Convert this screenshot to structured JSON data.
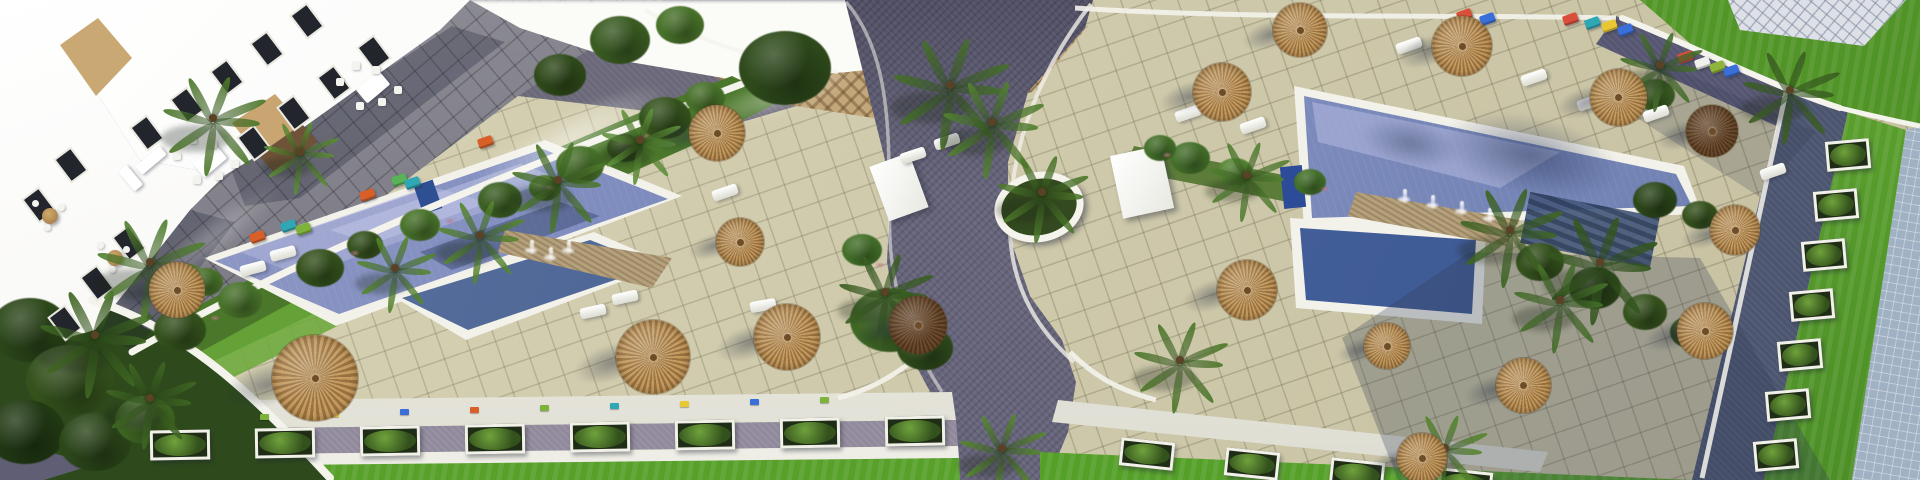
{
  "scene": {
    "kind": "aerial-architectural-render",
    "subject": "resort apartment complex with two swimming pools, tiled sun decks, straw parasols, palm gardens, paths and lawns",
    "view": "top-down oblique"
  },
  "palette": {
    "deck": "#d0caa8",
    "deck_line": "#5e563a",
    "terrace_tile": "#7d7c87",
    "road": "#615f76",
    "gravel": "#918a9c",
    "lawn": "#5aa12d",
    "garden": "#4b772b",
    "pool_rim": "#f2f1ea",
    "water_light": "#9aa0cc",
    "water_dark": "#49679f",
    "umbrella_tan": "#c49a5f",
    "umbrella_tan_dark": "#97713e",
    "umbrella_brown": "#6e4c2c",
    "rooftop": "#a0b1c4",
    "rock": "#b5a07a",
    "building_white": "#fbfbf7",
    "building_tan": "#c9a571"
  },
  "umbrellas": [
    [
      177,
      290,
      56,
      "t"
    ],
    [
      315,
      378,
      86,
      "t"
    ],
    [
      653,
      357,
      74,
      "t"
    ],
    [
      787,
      337,
      66,
      "t"
    ],
    [
      717,
      133,
      56,
      "t"
    ],
    [
      740,
      242,
      48,
      "t"
    ],
    [
      918,
      325,
      58,
      "d"
    ],
    [
      1222,
      92,
      58,
      "t"
    ],
    [
      1300,
      30,
      54,
      "t"
    ],
    [
      1462,
      46,
      60,
      "t"
    ],
    [
      1618,
      97,
      57,
      "t"
    ],
    [
      1712,
      131,
      52,
      "d"
    ],
    [
      1247,
      290,
      60,
      "t"
    ],
    [
      1735,
      230,
      50,
      "t"
    ],
    [
      1705,
      331,
      56,
      "t"
    ],
    [
      1523,
      385,
      55,
      "t"
    ],
    [
      1387,
      346,
      46,
      "t"
    ],
    [
      1422,
      458,
      50,
      "t"
    ]
  ],
  "palms": [
    [
      213,
      118,
      55,
      "#4e7a2b"
    ],
    [
      300,
      152,
      40,
      "#5d8f33"
    ],
    [
      395,
      268,
      42,
      "#57892e"
    ],
    [
      480,
      235,
      46,
      "#57892e"
    ],
    [
      558,
      180,
      50,
      "#4e7a2b"
    ],
    [
      640,
      140,
      42,
      "#61943a"
    ],
    [
      95,
      335,
      60,
      "#3f6623"
    ],
    [
      150,
      398,
      48,
      "#3f6623"
    ],
    [
      150,
      262,
      58,
      "#538231"
    ],
    [
      950,
      85,
      62,
      "#46702a"
    ],
    [
      992,
      122,
      54,
      "#538231"
    ],
    [
      1042,
      192,
      48,
      "#4e7a2b"
    ],
    [
      885,
      292,
      50,
      "#3c6023"
    ],
    [
      1002,
      448,
      46,
      "#57892e"
    ],
    [
      1247,
      175,
      44,
      "#538231"
    ],
    [
      1510,
      230,
      55,
      "#3f6623"
    ],
    [
      1600,
      262,
      60,
      "#35581e"
    ],
    [
      1560,
      300,
      50,
      "#46702a"
    ],
    [
      1660,
      65,
      44,
      "#46702a"
    ],
    [
      1790,
      90,
      52,
      "#3c6023"
    ],
    [
      1445,
      448,
      44,
      "#57892e"
    ],
    [
      1180,
      360,
      50,
      "#4e7a2b"
    ]
  ],
  "bushes": [
    [
      180,
      330,
      26,
      "#35521d"
    ],
    [
      240,
      300,
      22,
      "#48722a"
    ],
    [
      320,
      268,
      24,
      "#35521d"
    ],
    [
      420,
      225,
      20,
      "#48722a"
    ],
    [
      500,
      200,
      22,
      "#3c6023"
    ],
    [
      580,
      165,
      24,
      "#48722a"
    ],
    [
      665,
      118,
      26,
      "#35521d"
    ],
    [
      705,
      98,
      20,
      "#48722a"
    ],
    [
      620,
      40,
      30,
      "#3a5c22"
    ],
    [
      680,
      25,
      24,
      "#48722a"
    ],
    [
      560,
      75,
      26,
      "#2f4a1a"
    ],
    [
      785,
      68,
      46,
      "#2e4a1b"
    ],
    [
      890,
      320,
      40,
      "#3f6824"
    ],
    [
      925,
      348,
      28,
      "#2e4a1b"
    ],
    [
      862,
      250,
      20,
      "#44702a"
    ],
    [
      1190,
      158,
      20,
      "#44702a"
    ],
    [
      1235,
      172,
      18,
      "#538231"
    ],
    [
      1310,
      182,
      16,
      "#44702a"
    ],
    [
      1540,
      262,
      24,
      "#35521d"
    ],
    [
      1595,
      288,
      26,
      "#2c471a"
    ],
    [
      1645,
      312,
      22,
      "#35521d"
    ],
    [
      1690,
      332,
      20,
      "#2c471a"
    ],
    [
      30,
      330,
      40,
      "#2c471a"
    ],
    [
      70,
      380,
      44,
      "#35521d"
    ],
    [
      25,
      432,
      40,
      "#223a14"
    ],
    [
      95,
      442,
      36,
      "#2c471a"
    ],
    [
      145,
      420,
      30,
      "#3f6623"
    ],
    [
      1655,
      95,
      20,
      "#3c6023"
    ],
    [
      205,
      282,
      18,
      "#48722a"
    ],
    [
      365,
      245,
      18,
      "#35521d"
    ],
    [
      545,
      188,
      16,
      "#48722a"
    ],
    [
      625,
      148,
      18,
      "#35521d"
    ],
    [
      1160,
      148,
      16,
      "#44702a"
    ],
    [
      1655,
      200,
      22,
      "#2c471a"
    ],
    [
      1700,
      215,
      18,
      "#35521d"
    ]
  ],
  "flower_tufts": [
    [
      210,
      315
    ],
    [
      350,
      250
    ],
    [
      545,
      185
    ],
    [
      640,
      133
    ],
    [
      875,
      262
    ],
    [
      1162,
      152
    ],
    [
      1320,
      186
    ],
    [
      445,
      218
    ],
    [
      700,
      112
    ]
  ],
  "windows": [
    [
      365,
      40
    ],
    [
      325,
      70
    ],
    [
      285,
      100
    ],
    [
      245,
      130
    ],
    [
      298,
      8
    ],
    [
      258,
      36
    ],
    [
      218,
      64
    ],
    [
      178,
      92
    ],
    [
      138,
      120
    ],
    [
      120,
      230
    ],
    [
      88,
      270
    ],
    [
      56,
      310
    ],
    [
      62,
      152
    ],
    [
      30,
      192
    ]
  ],
  "white_loungers": [
    [
      240,
      263,
      -15
    ],
    [
      270,
      248,
      -15
    ],
    [
      580,
      306,
      -12
    ],
    [
      612,
      292,
      -12
    ],
    [
      750,
      300,
      -10
    ],
    [
      712,
      187,
      -19
    ],
    [
      900,
      150,
      -18
    ],
    [
      934,
      136,
      -18
    ],
    [
      1396,
      40,
      -19
    ],
    [
      1445,
      48,
      -19
    ],
    [
      1521,
      72,
      -19
    ],
    [
      1577,
      97,
      -19
    ],
    [
      1643,
      108,
      -19
    ],
    [
      1760,
      166,
      -19
    ],
    [
      1240,
      120,
      -19
    ],
    [
      1175,
      108,
      -19
    ]
  ],
  "color_loungers": [
    [
      250,
      232,
      "#d95f28"
    ],
    [
      281,
      221,
      "#2fa7b5"
    ],
    [
      296,
      224,
      "#7fb23a"
    ],
    [
      360,
      190,
      "#d95f28"
    ],
    [
      392,
      175,
      "#59b357"
    ],
    [
      405,
      178,
      "#2fa7b5"
    ],
    [
      478,
      137,
      "#d95f28"
    ],
    [
      1457,
      10,
      "#d94f3a"
    ],
    [
      1480,
      14,
      "#3a6fd9"
    ],
    [
      1563,
      14,
      "#d94f3a"
    ],
    [
      1585,
      18,
      "#2fa7b5"
    ],
    [
      1602,
      21,
      "#e8c832"
    ],
    [
      1618,
      25,
      "#3a6fd9"
    ],
    [
      1678,
      52,
      "#d94f3a"
    ],
    [
      1695,
      58,
      "#f0f0ec"
    ],
    [
      1710,
      62,
      "#8fb43a"
    ],
    [
      1724,
      66,
      "#3a6fd9"
    ]
  ],
  "flower_planters": [
    [
      260,
      414,
      "#7fb23a"
    ],
    [
      330,
      411,
      "#e8c832"
    ],
    [
      400,
      409,
      "#3a6fd9"
    ],
    [
      470,
      407,
      "#d95f28"
    ],
    [
      540,
      405,
      "#7fb23a"
    ],
    [
      610,
      403,
      "#2fa7b5"
    ],
    [
      680,
      401,
      "#e8c832"
    ],
    [
      750,
      399,
      "#3a6fd9"
    ],
    [
      820,
      397,
      "#7fb23a"
    ]
  ],
  "planter_boxes_bottom": [
    [
      150,
      430
    ],
    [
      255,
      428
    ],
    [
      360,
      426
    ],
    [
      465,
      424
    ],
    [
      570,
      422
    ],
    [
      675,
      420
    ],
    [
      780,
      418
    ],
    [
      885,
      416
    ]
  ],
  "planter_boxes_bottom_right": [
    [
      1120,
      440
    ],
    [
      1225,
      450
    ],
    [
      1330,
      460
    ],
    [
      1438,
      470
    ]
  ],
  "planter_boxes_band": [
    [
      1826,
      140
    ],
    [
      1814,
      190
    ],
    [
      1802,
      240
    ],
    [
      1790,
      290
    ],
    [
      1778,
      340
    ],
    [
      1766,
      390
    ],
    [
      1754,
      440
    ]
  ],
  "fountain_jets": [
    [
      530,
      240
    ],
    [
      549,
      247
    ],
    [
      567,
      240
    ],
    [
      1403,
      189
    ],
    [
      1431,
      195
    ],
    [
      1460,
      201
    ],
    [
      1488,
      208
    ]
  ],
  "furniture": {
    "dining_sets": [
      [
        195,
        152
      ],
      [
        358,
        78
      ]
    ],
    "sofas": [
      [
        135,
        155
      ]
    ],
    "round_tables": [
      [
        42,
        208
      ],
      [
        107,
        250
      ]
    ]
  }
}
